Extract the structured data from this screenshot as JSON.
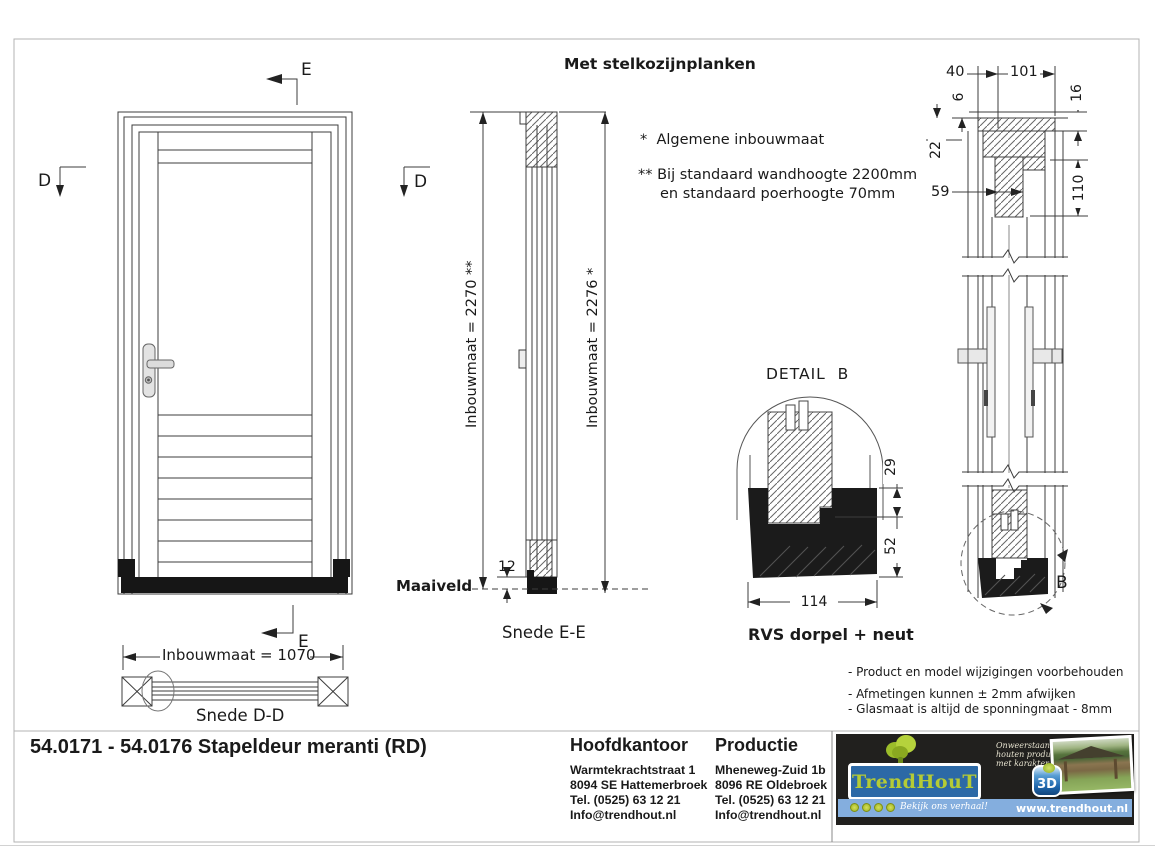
{
  "annotations": {
    "header_note": "Met stelkozijnplanken",
    "note_general": "*  Algemene inbouwmaat",
    "note_standard_1": "** Bij standaard wandhoogte 2200mm",
    "note_standard_2": "en standaard poerhoogte 70mm",
    "disclaimers": [
      "- Product en model wijzigingen voorbehouden",
      "- Afmetingen kunnen ± 2mm afwijken",
      "- Glasmaat is altijd de sponningmaat - 8mm"
    ]
  },
  "front_view": {
    "marker_e_top": "E",
    "marker_d_left": "D",
    "marker_d_right": "D",
    "marker_e_bottom": "E",
    "width_dim": "Inbouwmaat = 1070",
    "section_label": "Snede D-D"
  },
  "section_ee": {
    "dim_outer": "Inbouwmaat = 2270 **",
    "dim_inner": "Inbouwmaat = 2276 *",
    "ground_label": "Maaiveld",
    "dorpel_height": "12",
    "label": "Snede E-E"
  },
  "detail_b": {
    "title": "DETAIL  B",
    "caption": "RVS dorpel + neut",
    "dim_29": "29",
    "dim_52": "52",
    "dim_114": "114"
  },
  "section_b": {
    "dim_40": "40",
    "dim_101": "101",
    "dim_6": "6",
    "dim_16": "16",
    "dim_22": "22",
    "dim_59": "59",
    "dim_110": "110",
    "detail_ref": "B"
  },
  "title_block": {
    "drawing_title": "54.0171 - 54.0176 Stapeldeur meranti (RD)",
    "hoofdkantoor": {
      "heading": "Hoofdkantoor",
      "address1": "Warmtekrachtstraat 1",
      "address2": "8094 SE Hattemerbroek",
      "phone": "Tel. (0525) 63 12 21",
      "email": "Info@trendhout.nl"
    },
    "productie": {
      "heading": "Productie",
      "address1": "Mheneweg-Zuid 1b",
      "address2": "8096 RE Oldebroek",
      "phone": "Tel. (0525) 63 12 21",
      "email": "Info@trendhout.nl"
    }
  },
  "branding": {
    "brand_trend": "Trend",
    "brand_hout": "HouT",
    "tagline_1": "Onweerstaanbare",
    "tagline_2": "houten producten",
    "tagline_3": "met karakter",
    "badge_3d": "3D",
    "story_text": "Bekijk ons verhaal!",
    "website": "www.trendhout.nl",
    "colors": {
      "logo_blue": "#2c69a6",
      "lime_green": "#b5cb35",
      "strip_blue": "#84aede",
      "panel_black": "#21201e"
    }
  }
}
